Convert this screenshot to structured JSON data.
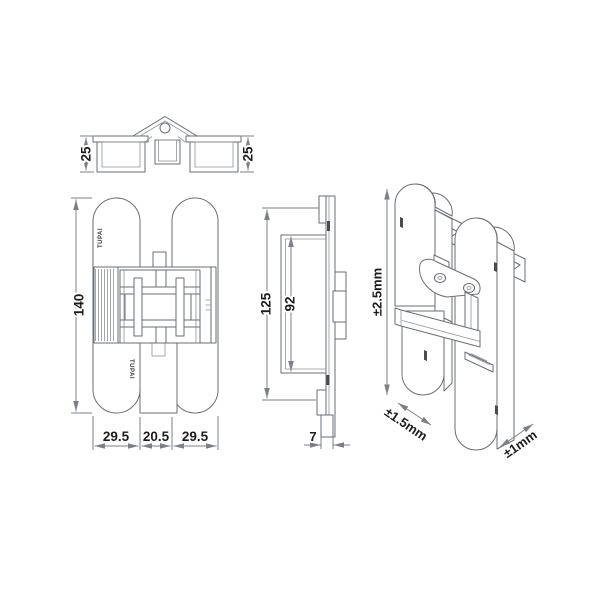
{
  "views": {
    "top": {
      "dim_left": "25",
      "dim_right": "25"
    },
    "front": {
      "height": "140",
      "width_left": "29.5",
      "width_center": "20.5",
      "width_right": "29.5",
      "brand_upper": "TUPAI",
      "brand_lower": "TUPAI"
    },
    "side": {
      "plate_height": "125",
      "inner_height": "92",
      "thickness": "7"
    },
    "perspective": {
      "vertical_adjustment": "±2.5mm",
      "lateral_adjustment": "±1.5mm",
      "depth_adjustment": "±1mm"
    }
  },
  "colors": {
    "line": "#6a6f74",
    "dimension_text": "#1c1c1c",
    "brand_text": "#3a3a3a",
    "background": "#ffffff"
  }
}
